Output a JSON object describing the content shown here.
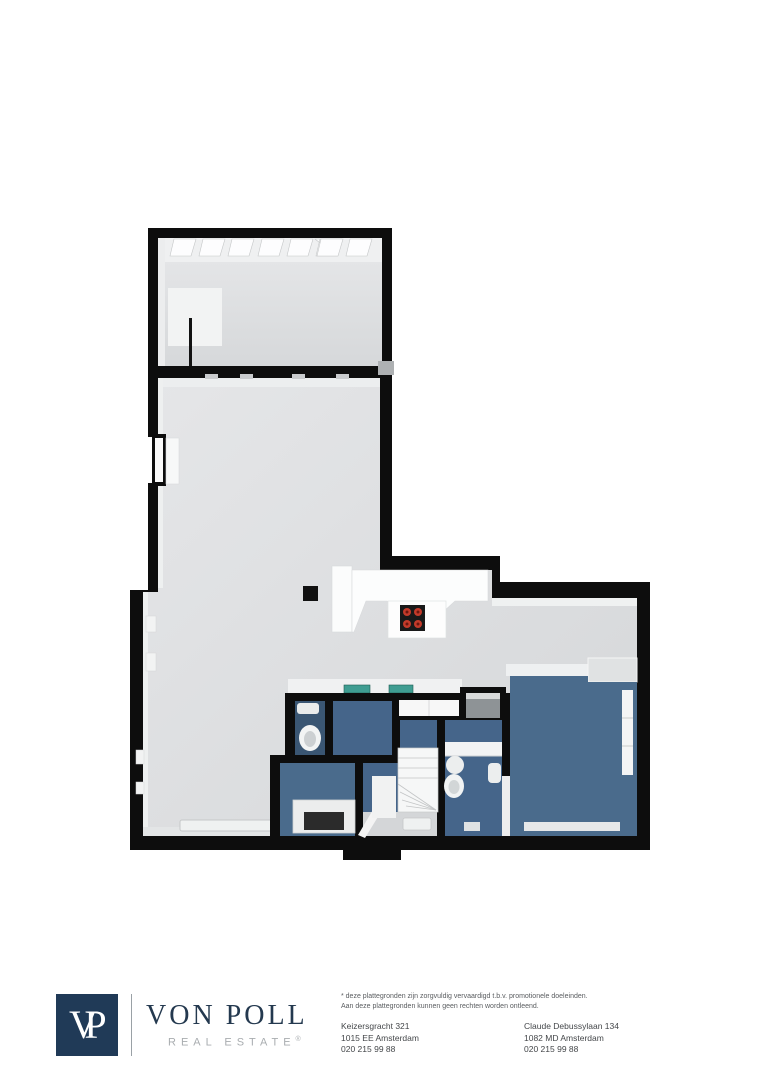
{
  "footer": {
    "logo": {
      "monogram": "VP",
      "name": "VON POLL",
      "tagline": "REAL ESTATE",
      "registered": "®"
    },
    "disclaimer_line1": "* deze plattegronden zijn zorgvuldig vervaardigd t.b.v. promotionele doeleinden.",
    "disclaimer_line2": "Aan deze plattegronden kunnen geen rechten worden ontleend.",
    "office1": {
      "street": "Keizersgracht 321",
      "city": "1015 EE Amsterdam",
      "phone": "020 215 99 88"
    },
    "office2": {
      "street": "Claude Debussylaan 134",
      "city": "1082 MD Amsterdam",
      "phone": "020 215 99 88"
    }
  },
  "floorplan": {
    "colors": {
      "wall": "#0d0d0d",
      "floor_gray": "#dcdee0",
      "blue_main": "#4a6b8c",
      "blue_mid": "#45658a",
      "blue_dark": "#3a5673",
      "sink_teal": "#3f9d92",
      "burner_red": "#c33a2a",
      "logo_navy": "#203a57",
      "logo_gray": "#9aa1a6"
    }
  }
}
